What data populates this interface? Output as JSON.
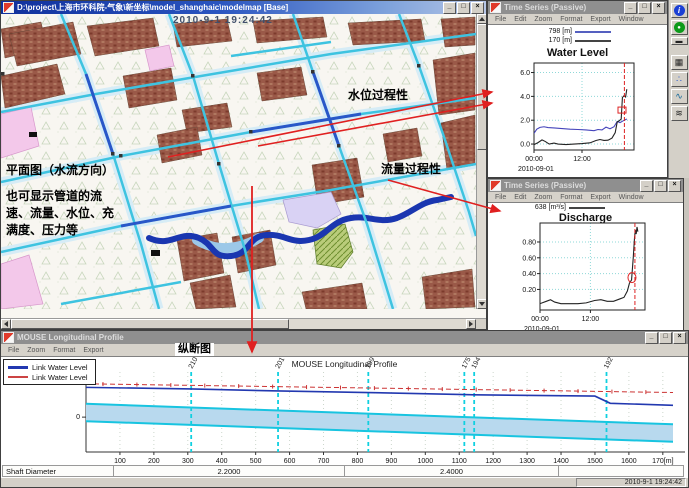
{
  "chrome": {
    "minimize": "_",
    "maximize": "□",
    "close": "×"
  },
  "map_window": {
    "title": "D:\\project\\上海市环科院-气象\\新坐标\\model_shanghaic\\modelmap [Base]",
    "timestamp": "2010-9-1 19:24:42",
    "annotations": {
      "plan_label": "平面图（水流方向）",
      "plan_note": "也可显示管道的流速、流量、水位、充满度、压力等",
      "water_level_arrow": "水位过程性",
      "discharge_arrow": "流量过程性"
    }
  },
  "timeseries_windows": [
    {
      "title": "Time Series (Passive)",
      "menu": [
        "File",
        "Edit",
        "Zoom",
        "Format",
        "Export",
        "Window"
      ]
    },
    {
      "title": "Time Series (Passive)",
      "menu": [
        "File",
        "Edit",
        "Zoom",
        "Format",
        "Export",
        "Window"
      ]
    }
  ],
  "toolbar": {
    "icons": [
      {
        "name": "info-icon",
        "glyph": "i"
      },
      {
        "name": "play-icon",
        "glyph": "●"
      },
      {
        "name": "minimize-dash-icon",
        "glyph": "▬"
      },
      {
        "name": "grid-view-icon",
        "glyph": "▦"
      },
      {
        "name": "scatter-plot-icon",
        "glyph": "∴"
      },
      {
        "name": "line-plot-icon",
        "glyph": "∿"
      },
      {
        "name": "layers-icon",
        "glyph": "≋"
      }
    ]
  },
  "profile_window": {
    "title": "MOUSE Longitudinal Profile",
    "menu": [
      "File",
      "Zoom",
      "Format",
      "Export"
    ],
    "annotation": "纵断图",
    "legend": [
      {
        "label": "Link Water Level",
        "color": "#2238b0"
      },
      {
        "label": "Link Water Level",
        "color": "#cc4444"
      }
    ],
    "table": {
      "header": "Shaft Diameter",
      "segments": [
        "2.2000",
        "2.4000"
      ]
    },
    "status_time": "2010-9-1 19:24:42"
  },
  "chart_data": [
    {
      "type": "line",
      "title": "Water Level",
      "legend": [
        {
          "label": "798 [m]",
          "color": "#5560c0"
        },
        {
          "label": "170 [m]",
          "color": "#444444"
        }
      ],
      "x_axis": {
        "xlim": [
          0,
          25
        ],
        "ticks": [
          {
            "t": 0,
            "label": "00:00"
          },
          {
            "t": 12,
            "label": "12:00"
          }
        ],
        "date_label": "2010-09-01"
      },
      "y_axis": {
        "ylim": [
          -0.5,
          6.8
        ],
        "ticks": [
          0,
          2,
          4,
          6
        ],
        "tick_labels": [
          "0.0",
          "2.0",
          "4.0",
          "6.0"
        ]
      },
      "series": [
        {
          "name": "798 [m]",
          "color": "#4444bb",
          "points": [
            [
              0,
              0.9
            ],
            [
              0.7,
              1.25
            ],
            [
              1.5,
              1.4
            ],
            [
              2.5,
              1.45
            ],
            [
              3.5,
              1.38
            ],
            [
              5,
              1.35
            ],
            [
              7,
              1.3
            ],
            [
              9,
              1.25
            ],
            [
              11,
              1.22
            ],
            [
              13,
              1.18
            ],
            [
              15,
              1.12
            ],
            [
              16,
              1.22
            ],
            [
              17,
              1.18
            ],
            [
              18,
              1.42
            ],
            [
              19,
              1.28
            ],
            [
              20,
              1.45
            ],
            [
              20.8,
              1.9
            ],
            [
              21.5,
              1.8
            ],
            [
              22.3,
              1.95
            ],
            [
              23.2,
              2.1
            ]
          ]
        },
        {
          "name": "170 [m]",
          "color": "#222222",
          "points": [
            [
              0,
              -0.05
            ],
            [
              1,
              0.12
            ],
            [
              2,
              0.35
            ],
            [
              2.8,
              0.22
            ],
            [
              3.8,
              0
            ],
            [
              5,
              0.08
            ],
            [
              6,
              0
            ],
            [
              8,
              -0.04
            ],
            [
              10,
              0
            ],
            [
              12,
              0.04
            ],
            [
              14,
              0.1
            ],
            [
              15.5,
              0.3
            ],
            [
              16.5,
              0.38
            ],
            [
              17.5,
              0.3
            ],
            [
              18.5,
              0.32
            ],
            [
              19.5,
              0.5
            ],
            [
              20.3,
              0.95
            ],
            [
              20.8,
              1.85
            ],
            [
              21.3,
              1.95
            ],
            [
              21.8,
              2.1
            ],
            [
              22.1,
              3.9
            ],
            [
              22.5,
              4.05
            ],
            [
              22.9,
              3.95
            ],
            [
              23.2,
              4.6
            ]
          ]
        }
      ],
      "cursor": {
        "x": 22.6,
        "color": "#dd2222"
      },
      "marker": {
        "shape": "rect",
        "x": 22.0,
        "y": 2.85,
        "color": "#dd2222"
      }
    },
    {
      "type": "line",
      "title": "Discharge",
      "legend": [
        {
          "label": "638 [m³/s]",
          "color": "#444444"
        }
      ],
      "x_axis": {
        "xlim": [
          0,
          25
        ],
        "ticks": [
          {
            "t": 0,
            "label": "00:00"
          },
          {
            "t": 12,
            "label": "12:00"
          }
        ],
        "date_label": "2010-09-01"
      },
      "y_axis": {
        "ylim": [
          -0.06,
          1.04
        ],
        "ticks": [
          0.2,
          0.4,
          0.6,
          0.8
        ],
        "tick_labels": [
          "0.20",
          "0.40",
          "0.60",
          "0.80"
        ]
      },
      "series": [
        {
          "name": "638 [m³/s]",
          "color": "#222222",
          "points": [
            [
              0,
              0.02
            ],
            [
              1.5,
              0.05
            ],
            [
              2.5,
              0.07
            ],
            [
              3.5,
              0.04
            ],
            [
              5,
              0.02
            ],
            [
              7,
              0.02
            ],
            [
              9,
              0.02
            ],
            [
              11,
              0.03
            ],
            [
              13,
              0.06
            ],
            [
              14.5,
              0.07
            ],
            [
              16,
              0.05
            ],
            [
              17.5,
              0.05
            ],
            [
              19,
              0.08
            ],
            [
              20,
              0.1
            ],
            [
              20.8,
              0.18
            ],
            [
              21.3,
              0.28
            ],
            [
              21.8,
              0.32
            ],
            [
              22.2,
              0.6
            ],
            [
              22.5,
              0.85
            ],
            [
              22.7,
              0.95
            ],
            [
              22.9,
              0.9
            ],
            [
              23.1,
              0.99
            ],
            [
              23.3,
              0.93
            ]
          ]
        }
      ],
      "cursor": {
        "x": 22.6,
        "color": "#dd2222"
      },
      "marker": {
        "shape": "ellipse",
        "x": 21.9,
        "y": 0.35,
        "color": "#dd2222"
      }
    },
    {
      "type": "profile",
      "title": "MOUSE Longitudinal Profile",
      "xlim": [
        0,
        1730
      ],
      "ylim": [
        -3.4,
        4.4
      ],
      "x_axis": {
        "tick_labels": [
          "100",
          "200",
          "300",
          "400",
          "500",
          "600",
          "700",
          "800",
          "900",
          "1000",
          "1100",
          "1200",
          "1300",
          "1400",
          "1500",
          "1600",
          "170[m]"
        ]
      },
      "y_axis": {
        "unit_label": "[m]",
        "zero_label": "0"
      },
      "nodes": [
        {
          "label": "210",
          "chainage": 310
        },
        {
          "label": "201",
          "chainage": 566
        },
        {
          "label": "199",
          "chainage": 832
        },
        {
          "label": "175",
          "chainage": 1115
        },
        {
          "label": "194",
          "chainage": 1144
        },
        {
          "label": "192",
          "chainage": 1534
        }
      ],
      "max_level_line": {
        "color": "#cc3333",
        "points": [
          [
            0,
            3.25
          ],
          [
            1730,
            2.4
          ]
        ]
      },
      "water_level_line": {
        "color": "#2238b0",
        "points": [
          [
            0,
            2.9
          ],
          [
            310,
            2.75
          ],
          [
            566,
            2.55
          ],
          [
            832,
            2.4
          ],
          [
            1115,
            2.2
          ],
          [
            1144,
            2.18
          ],
          [
            1500,
            2.05
          ],
          [
            1545,
            1.35
          ],
          [
            1730,
            1.15
          ]
        ]
      },
      "pipe": {
        "fill": "#b8d9ee",
        "edge": "#18c4e0",
        "top": [
          [
            0,
            1.3
          ],
          [
            1730,
            -0.7
          ]
        ],
        "bottom": [
          [
            0,
            -0.4
          ],
          [
            1730,
            -2.4
          ]
        ]
      }
    }
  ]
}
